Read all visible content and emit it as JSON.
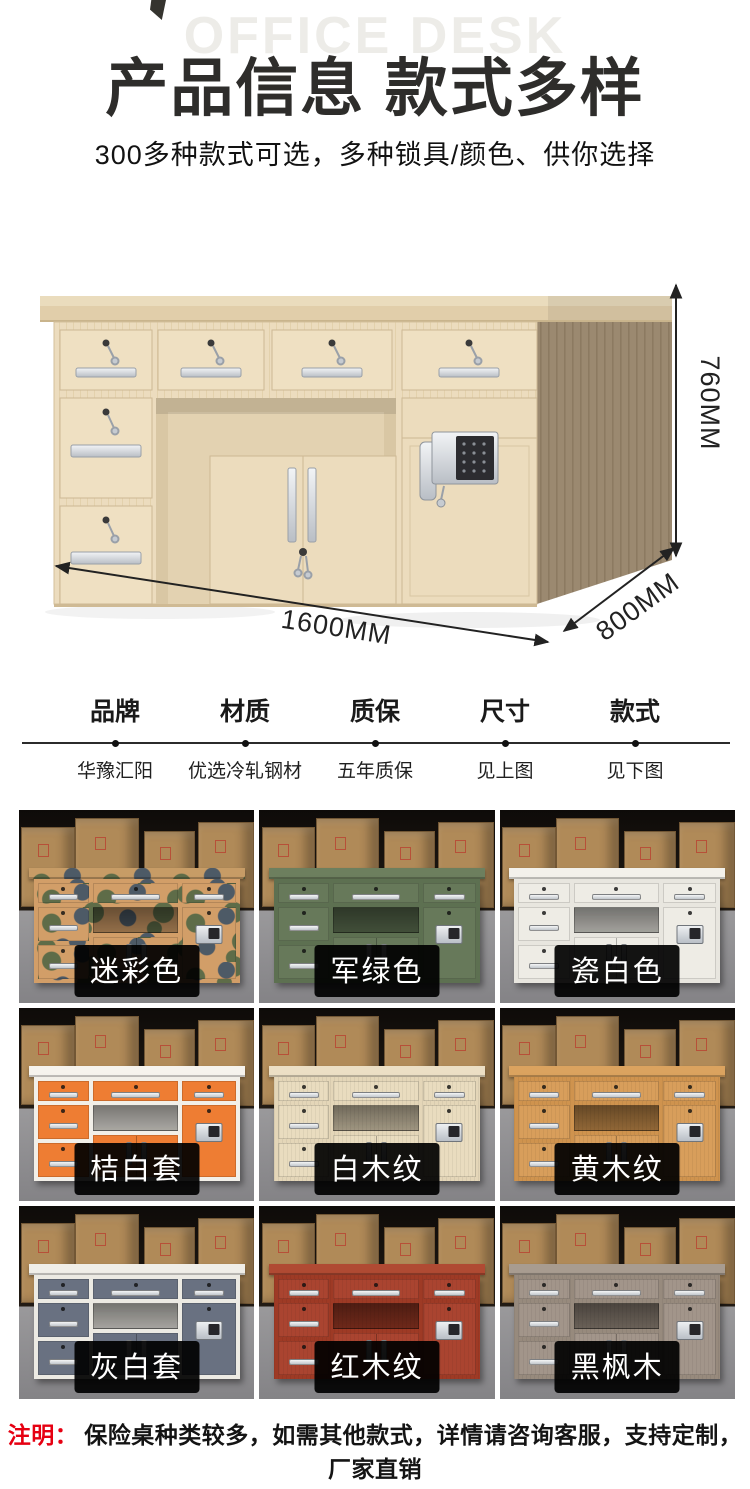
{
  "header": {
    "watermark": "OFFICE DESK",
    "title": "产品信息 款式多样",
    "subtitle": "300多种款式可选，多种锁具/颜色、供你选择"
  },
  "hero": {
    "dim_height": "760MM",
    "dim_width": "1600MM",
    "dim_depth": "800MM",
    "desk_colors": {
      "wood_light": "#ecdcbe",
      "wood_side": "#9b8970",
      "hardware_silver": "#c6cbd1",
      "keypad_dark": "#2c2c30"
    }
  },
  "specs": {
    "columns": [
      {
        "label": "品牌",
        "value": "华豫汇阳"
      },
      {
        "label": "材质",
        "value": "优选冷轧钢材"
      },
      {
        "label": "质保",
        "value": "五年质保"
      },
      {
        "label": "尺寸",
        "value": "见上图"
      },
      {
        "label": "款式",
        "value": "见下图"
      }
    ]
  },
  "gallery": {
    "items": [
      {
        "label": "迷彩色",
        "style": "camo",
        "colors": {
          "frame": "#d29e68",
          "drawer": "#d29e68",
          "top": "#c79c66",
          "camoG": "#5e6c48",
          "camoS": "#4d5a66"
        }
      },
      {
        "label": "军绿色",
        "style": "flat",
        "colors": {
          "frame": "#5d7051",
          "drawer": "#67795a",
          "top": "#6d7f5e"
        }
      },
      {
        "label": "瓷白色",
        "style": "flat",
        "colors": {
          "frame": "#e8e6df",
          "drawer": "#eeece5",
          "top": "#f3f1eb"
        }
      },
      {
        "label": "桔白套",
        "style": "flat",
        "colors": {
          "frame": "#f2efe8",
          "drawer": "#ee7d33",
          "top": "#f6f3ed"
        }
      },
      {
        "label": "白木纹",
        "style": "wood",
        "colors": {
          "frame": "#e4d6b8",
          "drawer": "#e9dcbf",
          "top": "#ecdfc5"
        }
      },
      {
        "label": "黄木纹",
        "style": "wood",
        "colors": {
          "frame": "#cf934e",
          "drawer": "#d89e5b",
          "top": "#dba35f"
        }
      },
      {
        "label": "灰白套",
        "style": "flat",
        "colors": {
          "frame": "#eceae3",
          "drawer": "#697181",
          "top": "#f0eee8"
        }
      },
      {
        "label": "红木纹",
        "style": "wood",
        "colors": {
          "frame": "#9e3a25",
          "drawer": "#aa4430",
          "top": "#b04a33"
        }
      },
      {
        "label": "黑枫木",
        "style": "wood",
        "colors": {
          "frame": "#978a7d",
          "drawer": "#a2958a",
          "top": "#a89c90"
        }
      }
    ]
  },
  "footnote": {
    "prefix": "注明：",
    "text": "保险桌种类较多，如需其他款式，详情请咨询客服，支持定制，厂家直销"
  }
}
